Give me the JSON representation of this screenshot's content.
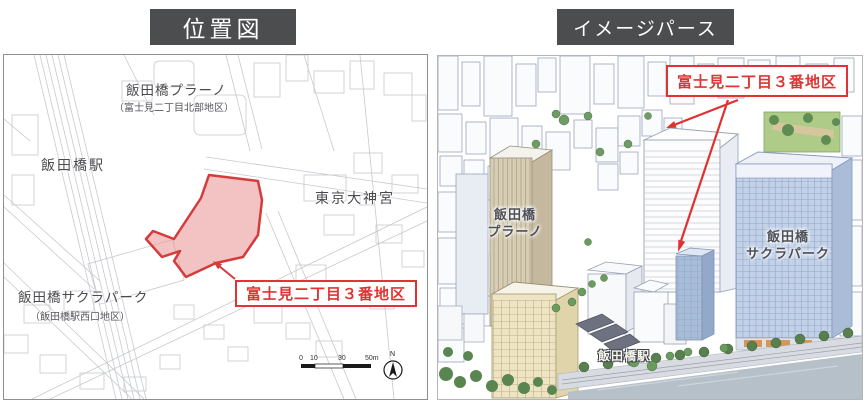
{
  "colors": {
    "title_bg": "#4b4d4f",
    "accent_red": "#e03434",
    "district_fill": "#ef9f9f",
    "map_line": "#c6c9cd",
    "sakura_tower": "#c2d1e8",
    "plano_tower": "#d6cdb4"
  },
  "left_panel": {
    "title": "位置図",
    "map_labels": {
      "plano": "飯田橋プラーノ",
      "plano_sub": "（富士見二丁目北部地区）",
      "iidabashi_station": "飯田橋駅",
      "tokyo_daijingu": "東京大神宮",
      "sakura_park": "飯田橋サクラパーク",
      "sakura_park_sub": "（飯田橋駅西口地区）"
    },
    "district_label": "富士見二丁目３番地区",
    "scale_bar": {
      "ticks": [
        "0",
        "10",
        "30",
        "50m"
      ]
    },
    "compass_label": "N"
  },
  "right_panel": {
    "title": "イメージパース",
    "district_label": "富士見二丁目３番地区",
    "labels": {
      "plano_line1": "飯田橋",
      "plano_line2": "プラーノ",
      "sakura_line1": "飯田橋",
      "sakura_line2": "サクラパーク",
      "station": "飯田橋駅"
    }
  }
}
